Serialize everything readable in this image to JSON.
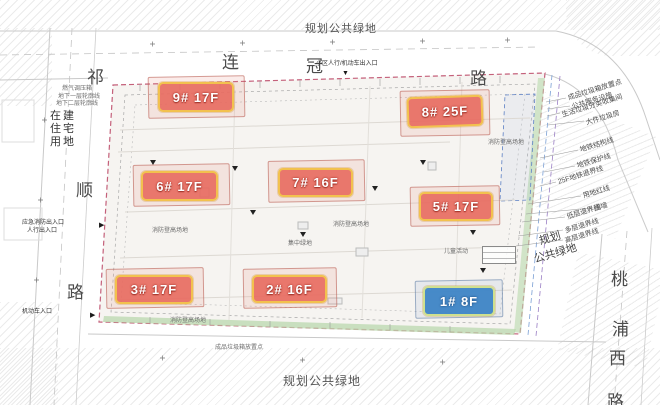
{
  "title": "住宅小区总平面图",
  "areas": {
    "top_green": "规划公共绿地",
    "bottom_green": "规划公共绿地",
    "right_green": [
      "规划",
      "公共绿地"
    ],
    "left_parcel_lines": [
      "在建",
      "住宅",
      "用地"
    ]
  },
  "roads": {
    "top": {
      "name": "连冠路",
      "chars": [
        "连",
        "冠",
        "路"
      ]
    },
    "left": {
      "name": "祁顺路",
      "chars": [
        "祁",
        "顺",
        "路"
      ]
    },
    "right": {
      "name": "桃浦西路",
      "chars": [
        "桃",
        "浦",
        "西",
        "路"
      ]
    }
  },
  "buildings": [
    {
      "label": "9# 17F",
      "color": "red"
    },
    {
      "label": "8# 25F",
      "color": "red"
    },
    {
      "label": "6# 17F",
      "color": "red"
    },
    {
      "label": "7# 16F",
      "color": "red"
    },
    {
      "label": "5# 17F",
      "color": "red"
    },
    {
      "label": "3# 17F",
      "color": "red"
    },
    {
      "label": "2# 16F",
      "color": "red"
    },
    {
      "label": "1# 8F",
      "color": "blue"
    }
  ],
  "legend": {
    "facilities": [
      "成品垃圾箱放置点",
      "公共服务设施",
      "生活垃圾分类收集间",
      "大件垃圾房"
    ],
    "lines": [
      "地铁结构线",
      "地铁保护线",
      "25F地铁退界线",
      "用地红线",
      "围墙",
      "低层退界线",
      "多层退界线",
      "高层退界线"
    ]
  },
  "entrances": {
    "top": "小区人行/机动车出入口",
    "left_emergency": "应急消防出入口",
    "left_pedestrian": "人行出入口",
    "left_vehicle": "机动车入口"
  },
  "annotations": {
    "gas_box": "燃气调压箱",
    "basement1": "地下一层轮廓线",
    "basement2": "地下二层轮廓线",
    "fire_area": "消防登高场地",
    "central_green": "集中绿地",
    "kids_area": "儿童活动",
    "trash_point": "成品垃圾箱放置点"
  },
  "icons": {
    "entrance_triangle_down": "▼",
    "entrance_triangle_right": "▶"
  },
  "colors": {
    "red_label_bg": "#e86a5e",
    "label_border_yellow": "#f2c14e",
    "blue_label_bg": "#3e85c6",
    "blue_label_border": "#cfe08f",
    "boundary_red": "#c4607a",
    "green_band": "#b9d8ae"
  }
}
